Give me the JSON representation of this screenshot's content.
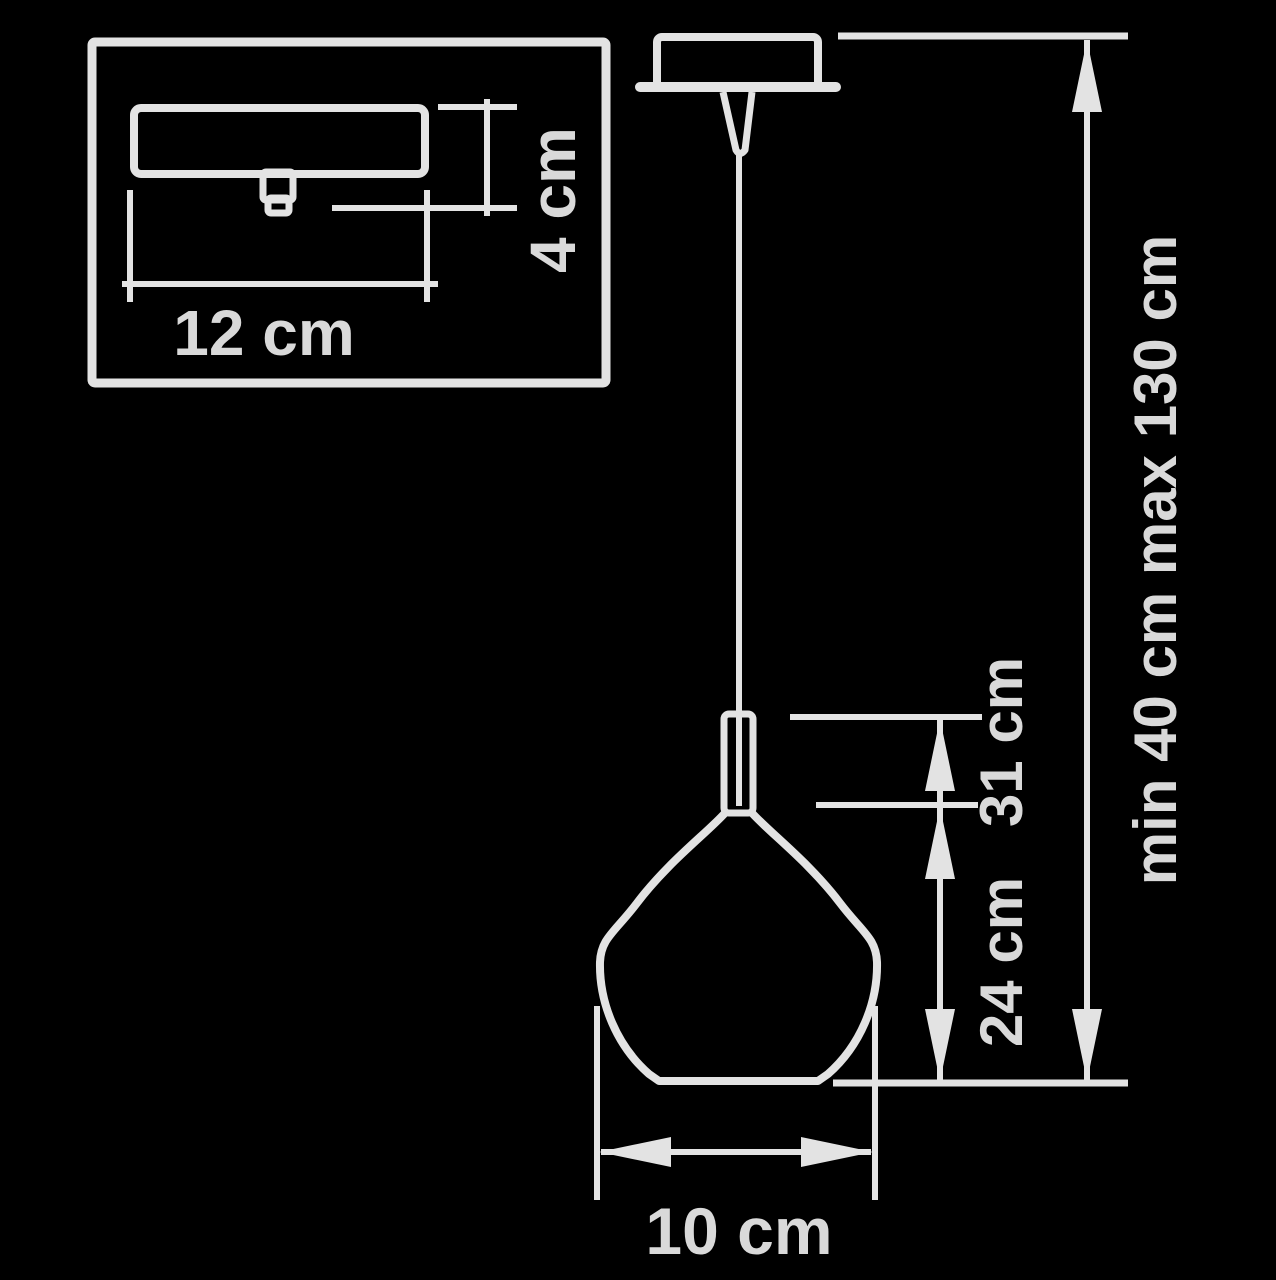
{
  "diagram": {
    "type": "technical-dimension-drawing",
    "subject": "pendant lamp suspension light",
    "background_color": "#000000",
    "line_color": "#e3e3e3",
    "text_color": "#d9d9d9",
    "inset": {
      "description": "ceiling canopy detail view",
      "width_label": "12 cm",
      "height_label": "4 cm"
    },
    "main": {
      "shade_width_label": "10 cm",
      "shade_height_label": "24 cm",
      "suspension_to_shade_label": "31 cm",
      "overall_height_label": "min 40 cm max 130 cm"
    }
  }
}
